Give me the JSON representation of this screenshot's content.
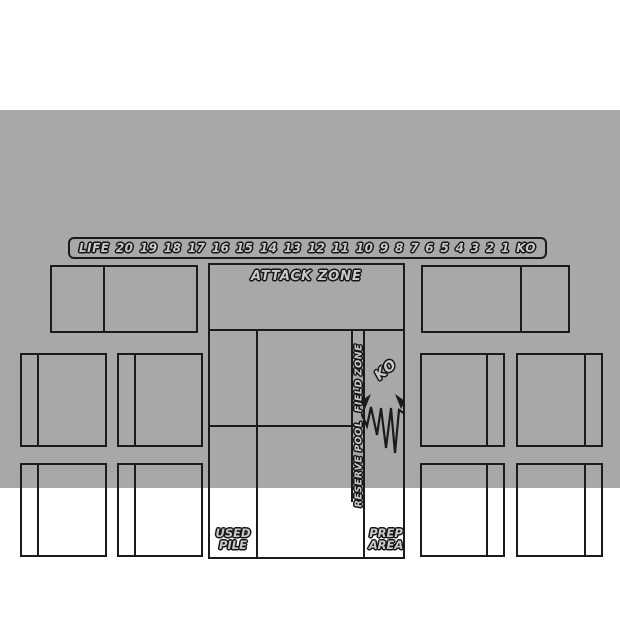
{
  "mat": {
    "background": "#a8a8a8",
    "line_color": "#1b1b1b"
  },
  "life_track": {
    "label": "LIFE",
    "values": [
      "20",
      "19",
      "18",
      "17",
      "16",
      "15",
      "14",
      "13",
      "12",
      "11",
      "10",
      "9",
      "8",
      "7",
      "6",
      "5",
      "4",
      "3",
      "2",
      "1",
      "KO"
    ]
  },
  "zones": {
    "attack_zone": "ATTACK ZONE",
    "field_zone": "FIELD ZONE",
    "reserve_pool": "RESERVE POOL",
    "ko": "KO",
    "used_pile": [
      "USED",
      "PILE"
    ],
    "prep_area": [
      "PREP",
      "AREA"
    ]
  }
}
